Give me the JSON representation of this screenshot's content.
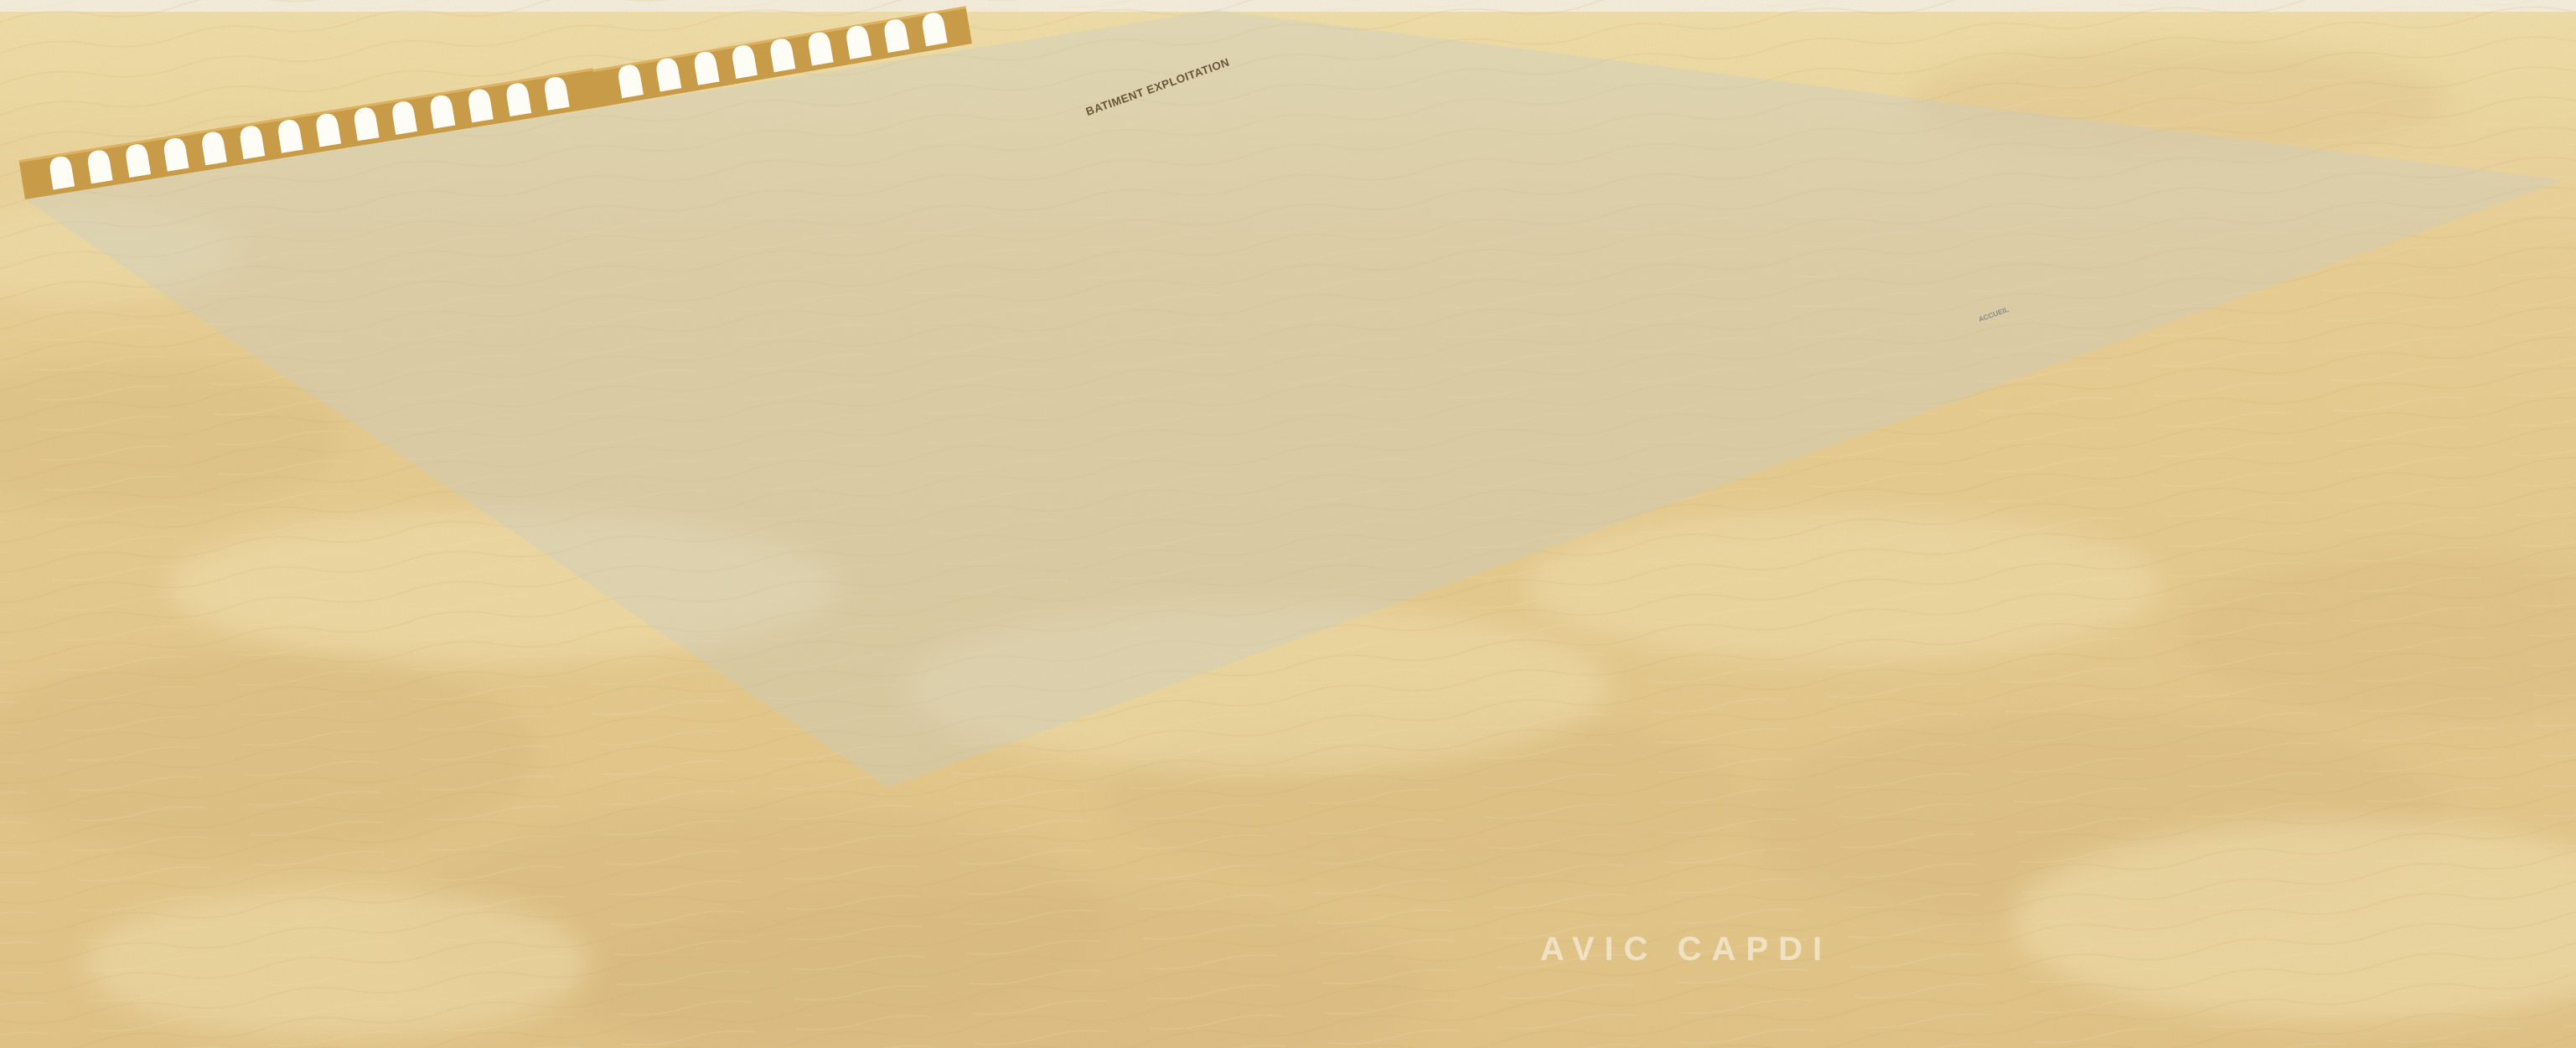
{
  "scene": {
    "type": "architectural-3d-rendering",
    "setting": "aerial view of a walled desert compound with arched perimeter walls, villas, apartment blocks, shade canopies, palm trees and a roundabout",
    "watermark": "AVIC  CAPDI",
    "labels": {
      "exploitation_building": "BATIMENT EXPLOITATION",
      "reception_gate": "ACCUEIL"
    }
  },
  "palette": {
    "sand": "#e9cf95",
    "sand_light": "#f4e4b4",
    "sand_dark": "#d9bb80",
    "wall": "#c89b49",
    "wall_dark": "#a97f33",
    "wall_light": "#dcb261",
    "arch": "#fdfdf6",
    "bldg_front": "#cfa04e",
    "bldg_side": "#ae8438",
    "roof": "#838268",
    "roof_edge": "#d8b468",
    "grass": "#5f9b3a",
    "grass_dark": "#47852e",
    "road": "#54575c",
    "road_line": "#f2f3f1",
    "paving": "#c7cac8",
    "paving_light": "#d6d8d5",
    "canopy": "#eceae2",
    "under_canopy": "#2f3338",
    "trunk": "#8d7c54",
    "frond": "#4d8a44",
    "shrub": "#9fae3e",
    "shrub_flower": "#e0cd52",
    "car_dark": "#24282d",
    "car_grey": "#9ba1a5",
    "car_white": "#f1f2f0",
    "shadow": "#7a6030"
  }
}
